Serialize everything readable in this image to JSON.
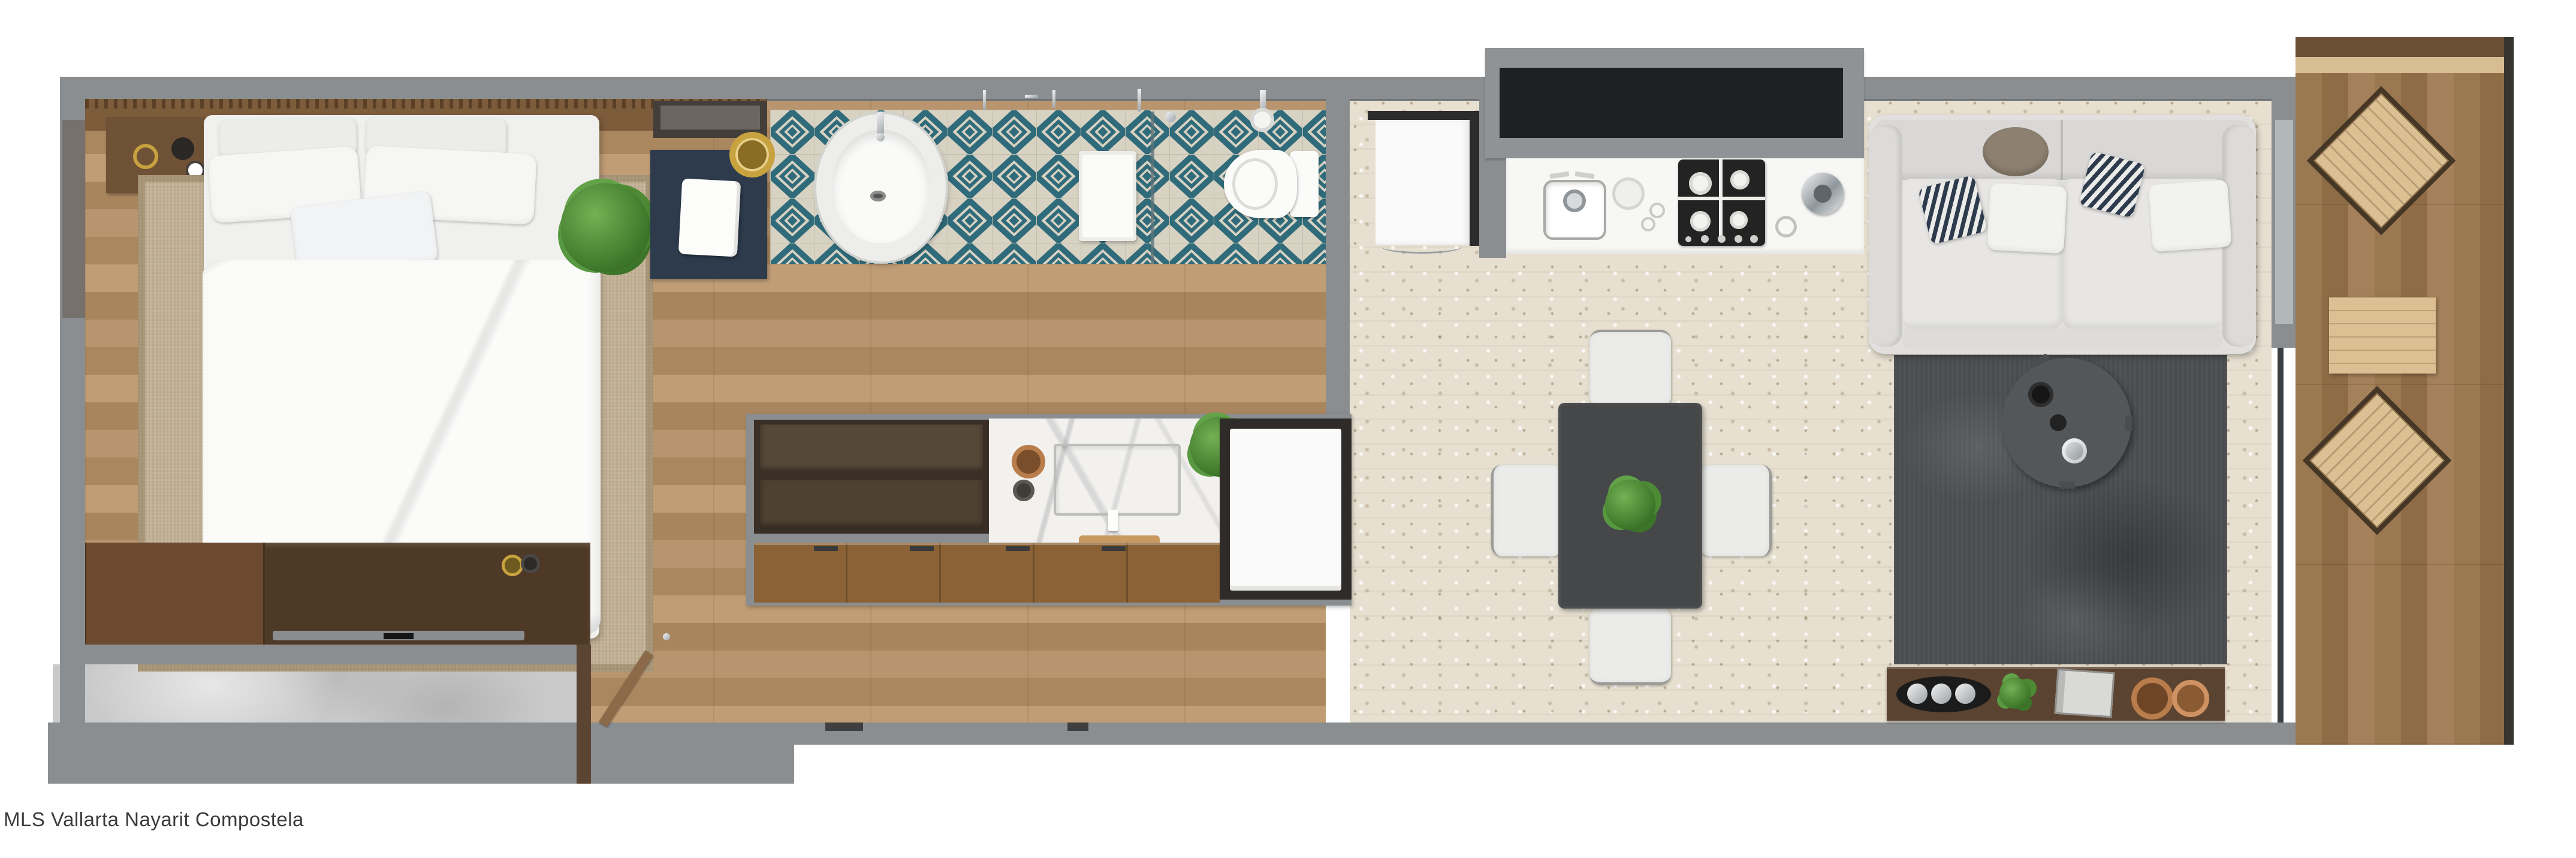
{
  "caption": {
    "text": "MLS Vallarta Nayarit Compostela"
  },
  "palette": {
    "wall": "#8b8e90",
    "wallShadow": "#6f7274",
    "wallDark": "#76716d",
    "black": "#1f2022",
    "blockGray": "#909395",
    "woodSeam": "#8a6844",
    "headboard": "#7d5c3b",
    "nightstand": "#6f5136",
    "consoleDark": "#4e3826",
    "consoleLight": "#6b4a2f",
    "deckThreshold": "#d8bd92",
    "deckChair": "#dcc094",
    "rail": "#37332e",
    "travertine": "#e7e0d1",
    "concrete": "#c9c9c9",
    "tileTeal": "#2f6b7a",
    "tileBg": "#d8d2c3",
    "tileGrout": "#c4bfae",
    "navy": "#2d3b4d",
    "gold": "#c7a23f",
    "copper": "#b97c4b",
    "offWhite": "#f3f3f1",
    "cushion": "#ececea",
    "sofa": "#e1e0de",
    "rugBeige": "#c3b194",
    "rugDark": "#4a4c4e",
    "tableRound": "#54575a",
    "diningTable": "#454749",
    "chairWhite": "#ebebe9",
    "marble": "#f2f1ee",
    "green": "#4d8a38",
    "caption": "#3a3a3a",
    "fridge": "#fafafa",
    "counter": "#f7f7f5"
  },
  "scene": {
    "rooms": [
      "bedroom",
      "bathroom",
      "hallway",
      "kitchen",
      "dining-area",
      "living-room",
      "balcony",
      "terrace"
    ]
  }
}
